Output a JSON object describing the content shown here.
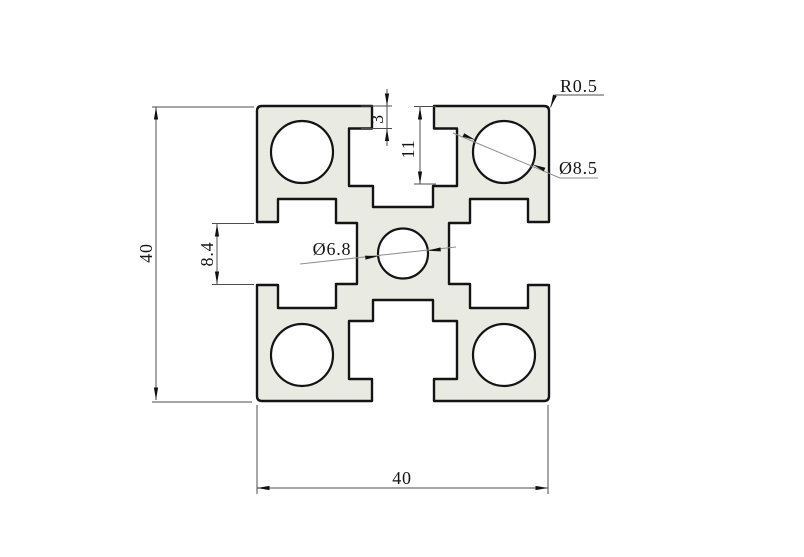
{
  "drawing": {
    "type": "technical-cross-section",
    "subject": "40x40 T-slot aluminium extrusion profile",
    "annotations": {
      "height_dim": "40",
      "width_dim": "40",
      "slot_opening_dim": "8.4",
      "slot_mouth_depth_dim": "3",
      "slot_cavity_depth_dim": "11",
      "corner_radius_label": "R0.5",
      "corner_hole_label": "Ø8.5",
      "center_hole_label": "Ø6.8"
    },
    "colors": {
      "background": "#ffffff",
      "profile_fill": "#e9ebe3",
      "outline": "#141414",
      "dimension_line": "#4d4d4d",
      "diameter_leader": "#8f8f8f",
      "text": "#151515"
    }
  }
}
